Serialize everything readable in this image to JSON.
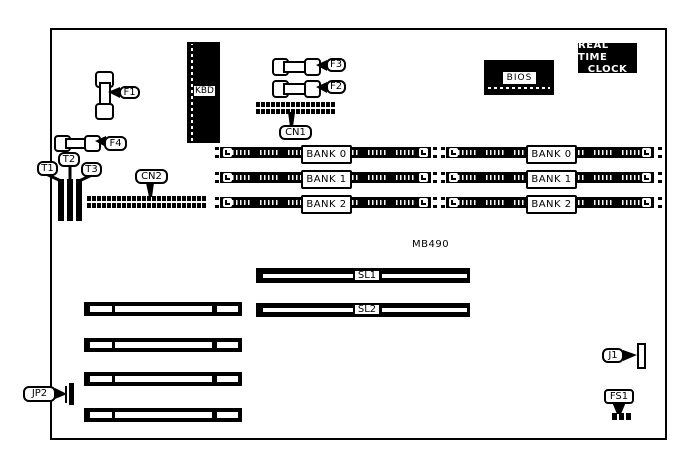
{
  "model": "MB490",
  "labels": {
    "kbd": "KBD",
    "f1": "F1",
    "f2": "F2",
    "f3": "F3",
    "f4": "F4",
    "t1": "T1",
    "t2": "T2",
    "t3": "T3",
    "cn1": "CN1",
    "cn2": "CN2",
    "bios": "BIOS",
    "rtc_line1": "REAL TIME",
    "rtc_line2": "CLOCK",
    "sl1": "SL1",
    "sl2": "SL2",
    "jp2": "JP2",
    "j1": "J1",
    "fs1": "FS1"
  },
  "memory": {
    "left_banks": [
      "BANK 0",
      "BANK 1",
      "BANK 2"
    ],
    "right_banks": [
      "BANK 0",
      "BANK 1",
      "BANK 2"
    ]
  },
  "colors": {
    "ink": "#000000",
    "paper": "#ffffff"
  }
}
